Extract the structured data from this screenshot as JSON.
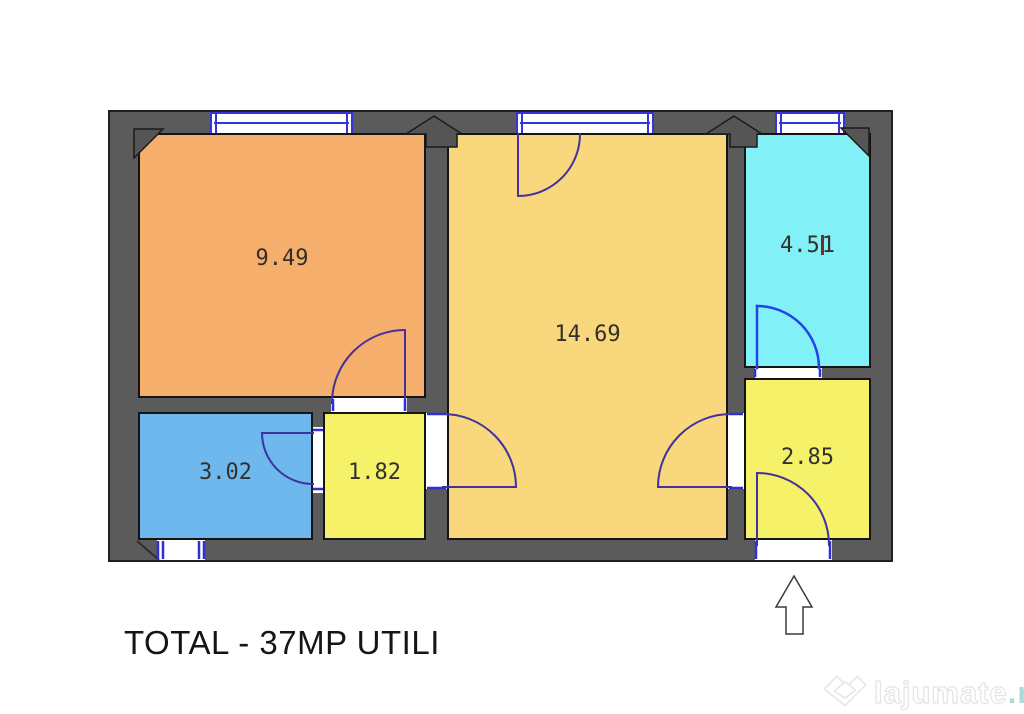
{
  "floor_plan": {
    "wall_color": "#5b5b5b",
    "window_frame_color": "#3535d8",
    "door_arc_color": "#42319e",
    "door_arc_color_bright": "#2143e8",
    "rooms": [
      {
        "id": "room-top-left",
        "area": "9.49",
        "color": "#f5ae6c"
      },
      {
        "id": "room-center",
        "area": "14.69",
        "color": "#f9d77d"
      },
      {
        "id": "room-top-right",
        "area": "4.51",
        "area_before_cursor": "4.5",
        "area_after_cursor": "1",
        "color": "#82f1f7"
      },
      {
        "id": "room-bottom-left",
        "area": "3.02",
        "color": "#6fb8ee"
      },
      {
        "id": "room-hallway",
        "area": "1.82",
        "color": "#f5f168"
      },
      {
        "id": "room-entry",
        "area": "2.85",
        "color": "#f5f168"
      }
    ]
  },
  "total_label": "TOTAL - 37MP UTILI",
  "watermark": {
    "brand": "lajumate",
    "tld": ".ro"
  }
}
